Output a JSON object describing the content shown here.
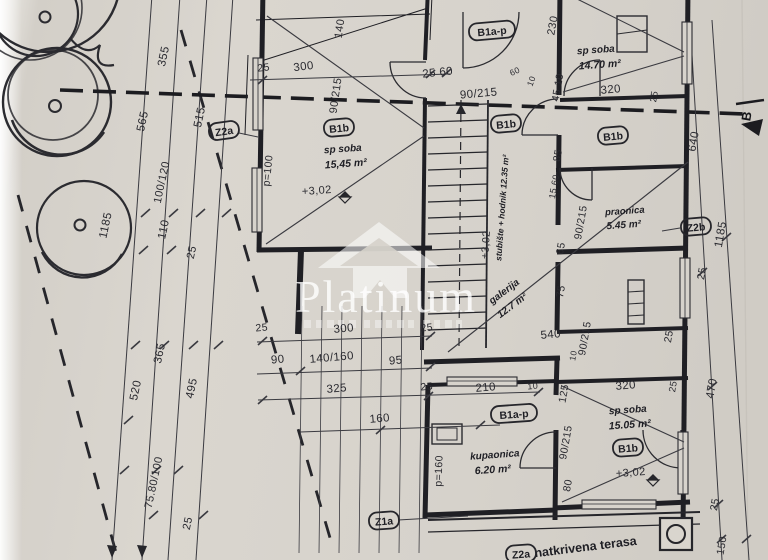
{
  "watermark": {
    "brand": "Platinum",
    "logo": "house-roof-icon"
  },
  "plan": {
    "rooms_summary": [
      {
        "tag": "B1b",
        "name": "sp soba",
        "area": "15,45 m²",
        "level": "+3,02"
      },
      {
        "name": "sp soba",
        "area": "14.70 m²"
      },
      {
        "tag": "B1b",
        "name": "praonica",
        "area": "5.45 m²"
      },
      {
        "name": "stubište + hodnik",
        "area": "12.35 m²",
        "level": "+3,02"
      },
      {
        "name": "galerija",
        "area": "12.7 m²"
      },
      {
        "tag": "B1a-p",
        "name": "kupaonica",
        "area": "6.20 m²"
      },
      {
        "tag": "B1b",
        "name": "sp soba",
        "area": "15.05 m²",
        "level": "+3,02"
      },
      {
        "name": "natkrivena terasa"
      }
    ],
    "labels": [
      {
        "name": "dim-355",
        "text": "355",
        "x": 167,
        "y": 57,
        "rot": -78,
        "size": 11.5,
        "cls": "dim"
      },
      {
        "name": "dim-565",
        "text": "565",
        "x": 146,
        "y": 122,
        "rot": -78,
        "size": 11.5,
        "cls": "dim"
      },
      {
        "name": "dim-515",
        "text": "515",
        "x": 203,
        "y": 118,
        "rot": -78,
        "size": 11.5,
        "cls": "dim"
      },
      {
        "name": "dim-100-120",
        "text": "100/120",
        "x": 165,
        "y": 183,
        "rot": -78,
        "size": 11,
        "cls": "dim"
      },
      {
        "name": "dim-110",
        "text": "110",
        "x": 167,
        "y": 230,
        "rot": -78,
        "size": 11.5,
        "cls": "dim"
      },
      {
        "name": "dim-25-left-a",
        "text": "25",
        "x": 195,
        "y": 253,
        "rot": -78,
        "size": 11,
        "cls": "dim"
      },
      {
        "name": "dim-1185-tree",
        "text": "1185",
        "x": 109,
        "y": 226,
        "rot": -78,
        "size": 11.5,
        "cls": "dim"
      },
      {
        "name": "dim-365",
        "text": "365",
        "x": 163,
        "y": 354,
        "rot": -78,
        "size": 11.5,
        "cls": "dim"
      },
      {
        "name": "dim-520",
        "text": "520",
        "x": 139,
        "y": 391,
        "rot": -78,
        "size": 11.5,
        "cls": "dim"
      },
      {
        "name": "dim-495",
        "text": "495",
        "x": 195,
        "y": 389,
        "rot": -78,
        "size": 11.5,
        "cls": "dim"
      },
      {
        "name": "dim-75-80-100",
        "text": "75.80/100",
        "x": 157,
        "y": 483,
        "rot": -78,
        "size": 11,
        "cls": "dim"
      },
      {
        "name": "dim-25-left-b",
        "text": "25",
        "x": 191,
        "y": 524,
        "rot": -78,
        "size": 11,
        "cls": "dim"
      },
      {
        "name": "dim-25-top",
        "text": "25",
        "x": 264,
        "y": 71,
        "rot": -7,
        "size": 10.5,
        "cls": "dim"
      },
      {
        "name": "dim-300-top",
        "text": "300",
        "x": 304,
        "y": 70,
        "rot": -7,
        "size": 11.5,
        "cls": "dim"
      },
      {
        "name": "dim-140",
        "text": "140",
        "x": 343,
        "y": 29,
        "rot": -82,
        "size": 11,
        "cls": "dim"
      },
      {
        "name": "dim-90-215-a",
        "text": "90/215",
        "x": 339,
        "y": 96,
        "rot": -82,
        "size": 11,
        "cls": "dim"
      },
      {
        "name": "dim-25-60",
        "text": "25 60",
        "x": 438,
        "y": 76,
        "rot": -6,
        "size": 11.5,
        "cls": "dim"
      },
      {
        "name": "dim-90-215-b",
        "text": "90/215",
        "x": 479,
        "y": 97,
        "rot": -5,
        "size": 11.5,
        "cls": "dim"
      },
      {
        "name": "dim-60-small",
        "text": "60",
        "x": 516,
        "y": 74,
        "rot": -25,
        "size": 8.5,
        "cls": "dim"
      },
      {
        "name": "dim-10-small-a",
        "text": "10",
        "x": 534,
        "y": 82,
        "rot": -70,
        "size": 8.5,
        "cls": "dim"
      },
      {
        "name": "dim-230",
        "text": "230",
        "x": 556,
        "y": 26,
        "rot": -80,
        "size": 11,
        "cls": "dim"
      },
      {
        "name": "dim-45-10",
        "text": "45 10",
        "x": 561,
        "y": 88,
        "rot": -80,
        "size": 10.5,
        "cls": "dim"
      },
      {
        "name": "dim-320-top",
        "text": "320",
        "x": 611,
        "y": 93,
        "rot": -5,
        "size": 11.5,
        "cls": "dim"
      },
      {
        "name": "dim-25-tr",
        "text": "25",
        "x": 657,
        "y": 97,
        "rot": -80,
        "size": 9.5,
        "cls": "dim"
      },
      {
        "name": "room-spsoba1-name",
        "text": "sp soba",
        "x": 596,
        "y": 53,
        "rot": -4,
        "size": 10,
        "cls": "room"
      },
      {
        "name": "room-spsoba1-area",
        "text": "14.70 m²",
        "x": 600,
        "y": 68,
        "rot": -4,
        "size": 10.5,
        "cls": "area"
      },
      {
        "name": "room-spsoba2-name",
        "text": "sp soba",
        "x": 343,
        "y": 152,
        "rot": -4,
        "size": 10,
        "cls": "room"
      },
      {
        "name": "room-spsoba2-area",
        "text": "15,45 m²",
        "x": 346,
        "y": 167,
        "rot": -4,
        "size": 10.5,
        "cls": "area"
      },
      {
        "name": "level-left-room",
        "text": "+3,02",
        "x": 317,
        "y": 194,
        "rot": -4,
        "size": 11,
        "cls": "dim"
      },
      {
        "name": "dim-p100",
        "text": "p=100",
        "x": 271,
        "y": 171,
        "rot": -84,
        "size": 10.5,
        "cls": "dim"
      },
      {
        "name": "level-stair",
        "text": "+3,02",
        "x": 489,
        "y": 245,
        "rot": -86,
        "size": 10.5,
        "cls": "dim"
      },
      {
        "name": "room-stair-name",
        "text": "stubište + hodnik 12.35 m²",
        "x": 505,
        "y": 208,
        "rot": -86,
        "size": 8.5,
        "cls": "room"
      },
      {
        "name": "room-galerija-name",
        "text": "galerija",
        "x": 506,
        "y": 294,
        "rot": -37,
        "size": 10,
        "cls": "room"
      },
      {
        "name": "room-galerija-area",
        "text": "12.7 m²",
        "x": 514,
        "y": 308,
        "rot": -37,
        "size": 10,
        "cls": "area"
      },
      {
        "name": "dim-85",
        "text": "85",
        "x": 561,
        "y": 156,
        "rot": -80,
        "size": 10.5,
        "cls": "dim"
      },
      {
        "name": "dim-15-60",
        "text": "15 60",
        "x": 557,
        "y": 187,
        "rot": -80,
        "size": 9,
        "cls": "dim"
      },
      {
        "name": "dim-65",
        "text": "65",
        "x": 564,
        "y": 249,
        "rot": -80,
        "size": 10.5,
        "cls": "dim"
      },
      {
        "name": "dim-75",
        "text": "75",
        "x": 564,
        "y": 292,
        "rot": -80,
        "size": 10.5,
        "cls": "dim"
      },
      {
        "name": "dim-90-215-c",
        "text": "90/215",
        "x": 584,
        "y": 223,
        "rot": -80,
        "size": 10.5,
        "cls": "dim"
      },
      {
        "name": "room-praonica-name",
        "text": "praonica",
        "x": 625,
        "y": 214,
        "rot": -4,
        "size": 9.5,
        "cls": "room"
      },
      {
        "name": "room-praonica-area",
        "text": "5.45 m²",
        "x": 624,
        "y": 228,
        "rot": -4,
        "size": 10,
        "cls": "area"
      },
      {
        "name": "dim-90-215-d",
        "text": "90/215",
        "x": 588,
        "y": 339,
        "rot": -80,
        "size": 10.5,
        "cls": "dim"
      },
      {
        "name": "dim-540",
        "text": "540",
        "x": 551,
        "y": 338,
        "rot": -5,
        "size": 11.5,
        "cls": "dim"
      },
      {
        "name": "dim-10-small-b",
        "text": "10",
        "x": 576,
        "y": 356,
        "rot": -80,
        "size": 8.5,
        "cls": "dim"
      },
      {
        "name": "dim-640",
        "text": "640",
        "x": 697,
        "y": 142,
        "rot": -80,
        "size": 11.5,
        "cls": "dim"
      },
      {
        "name": "dim-1185-right",
        "text": "1185",
        "x": 724,
        "y": 235,
        "rot": -80,
        "size": 11.5,
        "cls": "dim"
      },
      {
        "name": "dim-25-right-a",
        "text": "25",
        "x": 705,
        "y": 274,
        "rot": -80,
        "size": 10.5,
        "cls": "dim"
      },
      {
        "name": "dim-25-bl-a",
        "text": "25",
        "x": 262,
        "y": 331,
        "rot": -5,
        "size": 10.5,
        "cls": "dim"
      },
      {
        "name": "dim-300-b",
        "text": "300",
        "x": 344,
        "y": 332,
        "rot": -5,
        "size": 11.5,
        "cls": "dim"
      },
      {
        "name": "dim-25-bl-b",
        "text": "25",
        "x": 427,
        "y": 331,
        "rot": -5,
        "size": 10.5,
        "cls": "dim"
      },
      {
        "name": "dim-90-b",
        "text": "90",
        "x": 278,
        "y": 363,
        "rot": -5,
        "size": 11.5,
        "cls": "dim"
      },
      {
        "name": "dim-140-160",
        "text": "140/160",
        "x": 332,
        "y": 361,
        "rot": -5,
        "size": 11.5,
        "cls": "dim"
      },
      {
        "name": "dim-95",
        "text": "95",
        "x": 396,
        "y": 364,
        "rot": -5,
        "size": 11.5,
        "cls": "dim"
      },
      {
        "name": "dim-325",
        "text": "325",
        "x": 337,
        "y": 392,
        "rot": -5,
        "size": 11.5,
        "cls": "dim"
      },
      {
        "name": "dim-25-bl-c",
        "text": "25",
        "x": 427,
        "y": 390,
        "rot": -5,
        "size": 10.5,
        "cls": "dim"
      },
      {
        "name": "dim-210",
        "text": "210",
        "x": 486,
        "y": 391,
        "rot": -5,
        "size": 11.5,
        "cls": "dim"
      },
      {
        "name": "dim-10-small-c",
        "text": "10",
        "x": 533,
        "y": 389,
        "rot": -5,
        "size": 9,
        "cls": "dim"
      },
      {
        "name": "dim-160-b",
        "text": "160",
        "x": 380,
        "y": 422,
        "rot": -5,
        "size": 11.5,
        "cls": "dim"
      },
      {
        "name": "dim-p160",
        "text": "p=160",
        "x": 442,
        "y": 471,
        "rot": -88,
        "size": 10.5,
        "cls": "dim"
      },
      {
        "name": "room-kupaonica-name",
        "text": "kupaonica",
        "x": 495,
        "y": 458,
        "rot": -4,
        "size": 10,
        "cls": "room"
      },
      {
        "name": "room-kupaonica-area",
        "text": "6.20 m²",
        "x": 493,
        "y": 473,
        "rot": -4,
        "size": 10.5,
        "cls": "area"
      },
      {
        "name": "dim-125",
        "text": "125",
        "x": 567,
        "y": 394,
        "rot": -80,
        "size": 10.5,
        "cls": "dim"
      },
      {
        "name": "dim-320-b",
        "text": "320",
        "x": 626,
        "y": 389,
        "rot": -5,
        "size": 11.5,
        "cls": "dim"
      },
      {
        "name": "dim-25-br-a",
        "text": "25",
        "x": 676,
        "y": 387,
        "rot": -80,
        "size": 9.5,
        "cls": "dim"
      },
      {
        "name": "dim-90-215-e",
        "text": "90/215",
        "x": 569,
        "y": 443,
        "rot": -80,
        "size": 10.5,
        "cls": "dim"
      },
      {
        "name": "dim-80",
        "text": "80",
        "x": 571,
        "y": 486,
        "rot": -80,
        "size": 10.5,
        "cls": "dim"
      },
      {
        "name": "room-spsoba3-name",
        "text": "sp soba",
        "x": 628,
        "y": 413,
        "rot": -4,
        "size": 10,
        "cls": "room"
      },
      {
        "name": "room-spsoba3-area",
        "text": "15.05 m²",
        "x": 630,
        "y": 428,
        "rot": -4,
        "size": 10.5,
        "cls": "area"
      },
      {
        "name": "level-spsoba3",
        "text": "+3,02",
        "x": 631,
        "y": 476,
        "rot": -4,
        "size": 11,
        "cls": "dim"
      },
      {
        "name": "dim-470",
        "text": "470",
        "x": 715,
        "y": 389,
        "rot": -80,
        "size": 11.5,
        "cls": "dim"
      },
      {
        "name": "dim-25-br-b",
        "text": "25",
        "x": 672,
        "y": 337,
        "rot": -80,
        "size": 10.5,
        "cls": "dim"
      },
      {
        "name": "dim-25-br-c",
        "text": "25",
        "x": 718,
        "y": 505,
        "rot": -80,
        "size": 10.5,
        "cls": "dim"
      },
      {
        "name": "dim-150",
        "text": "150",
        "x": 725,
        "y": 546,
        "rot": -80,
        "size": 10.5,
        "cls": "dim"
      },
      {
        "name": "terrace-name",
        "text": "natkrivena terasa",
        "x": 586,
        "y": 551,
        "rot": -7,
        "size": 12.5,
        "cls": "name"
      },
      {
        "name": "section-marker-b",
        "text": "B",
        "x": 751,
        "y": 117,
        "rot": -80,
        "size": 13,
        "cls": "marker"
      }
    ],
    "tags": [
      {
        "name": "tag-z2a",
        "text": "Z2a",
        "x": 224,
        "y": 131,
        "rot": -8
      },
      {
        "name": "tag-b1ap-top",
        "text": "B1a-p",
        "x": 492,
        "y": 31,
        "rot": -5
      },
      {
        "name": "tag-b1b-1",
        "text": "B1b",
        "x": 339,
        "y": 128,
        "rot": -5
      },
      {
        "name": "tag-b1b-2",
        "text": "B1b",
        "x": 506,
        "y": 124,
        "rot": -5
      },
      {
        "name": "tag-b1b-3",
        "text": "B1b",
        "x": 613,
        "y": 136,
        "rot": -5
      },
      {
        "name": "tag-z2b",
        "text": "Z2b",
        "x": 696,
        "y": 227,
        "rot": -5
      },
      {
        "name": "tag-z1a",
        "text": "Z1a",
        "x": 384,
        "y": 521,
        "rot": -4
      },
      {
        "name": "tag-b1ap-2",
        "text": "B1a-p",
        "x": 514,
        "y": 414,
        "rot": -4
      },
      {
        "name": "tag-b1b-4",
        "text": "B1b",
        "x": 628,
        "y": 448,
        "rot": -4
      },
      {
        "name": "tag-z2a-2",
        "text": "Z2a",
        "x": 521,
        "y": 554,
        "rot": -4
      }
    ],
    "level_markers": [
      {
        "x": 345,
        "y": 197
      },
      {
        "x": 653,
        "y": 480
      }
    ],
    "colors": {
      "ink": "#26262b",
      "paper": "#d7d3cc"
    }
  }
}
